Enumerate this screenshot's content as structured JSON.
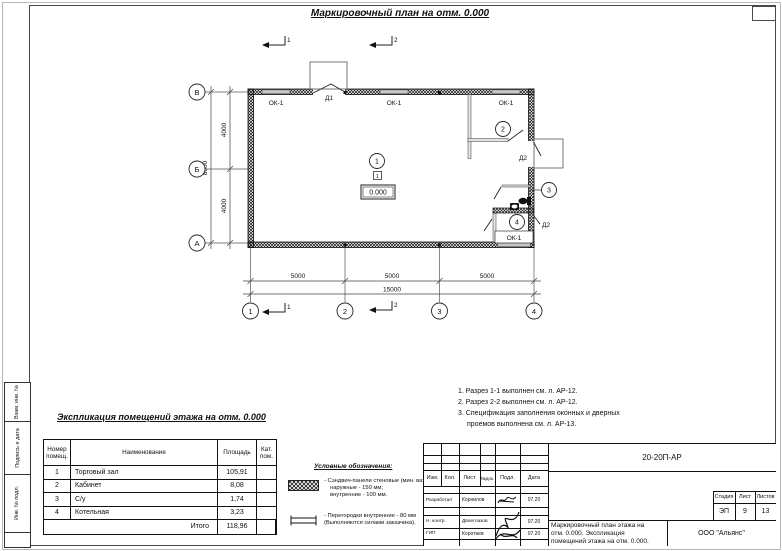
{
  "title": "Маркировочный план на отм. 0.000",
  "plan": {
    "window_label": "ОК-1",
    "door1": "Д1",
    "door2": "Д2",
    "room1": "1",
    "room2": "2",
    "room3": "3",
    "room4": "4",
    "floor_type": "1",
    "elevation": "0.000",
    "section1": "1",
    "section2": "2",
    "axis_rows": {
      "top": "В",
      "mid": "Б",
      "bottom": "А"
    },
    "axis_cols": {
      "c1": "1",
      "c2": "2",
      "c3": "3",
      "c4": "4"
    },
    "dims": {
      "v1": "4000",
      "v2": "4000",
      "v_total": "8000",
      "h1": "5000",
      "h2": "5000",
      "h3": "5000",
      "h_total": "15000"
    }
  },
  "notes": {
    "line1": "1. Разрез 1-1 выполнен см. л. АР-12.",
    "line2": "2. Разрез 2-2 выполнен см. л. АР-12.",
    "line3": "3. Спецификация заполнения оконных и дверных",
    "line4": "проемов выполнена см. л. АР-13."
  },
  "explication": {
    "title": "Экспликация помещений этажа на отм. 0.000",
    "col_number": "Номер помещ.",
    "col_name": "Наименование",
    "col_area": "Площадь",
    "col_cat": "Кат. пом.",
    "rows": [
      {
        "num": "1",
        "name": "Торговый зал",
        "area": "105,91"
      },
      {
        "num": "2",
        "name": "Кабинет",
        "area": "8,08"
      },
      {
        "num": "3",
        "name": "С/у",
        "area": "1,74"
      },
      {
        "num": "4",
        "name": "Котельная",
        "area": "3,23"
      }
    ],
    "total_label": "Итого",
    "total": "118,96"
  },
  "legend": {
    "title": "Условные обозначения:",
    "item1_line1": "- Сэндвич-панели стеновые (мин. вата):",
    "item1_line2": "наружные - 150 мм;",
    "item1_line3": "внутренние - 100 мм.",
    "item2_line1": "- Перегородки внутренние - 80 мм",
    "item2_line2": "(Выполняются силами заказчика)."
  },
  "stamp": {
    "doc_number": "20-20П-АР",
    "cols": {
      "izm": "Изм.",
      "kol": "Кол.",
      "list": "Лист",
      "ndoc": "№док.",
      "podp": "Подл.",
      "data": "Дата"
    },
    "row1_role": "Разработал",
    "row1_name": "Корнилов",
    "row1_date": "07.20",
    "row2_role": "Н. контр.",
    "row2_name": "Двоеглазов",
    "row2_date": "07.20",
    "row3_role": "ГИП",
    "row3_name": "Коротаев",
    "row3_date": "07.20",
    "title_line1": "Маркировочный план этажа на",
    "title_line2": "отм. 0.000. Экспликация",
    "title_line3": "помещений этажа на отм. 0.000.",
    "stage_label": "Стадия",
    "stage": "ЭП",
    "sheet_label": "Лист",
    "sheet": "9",
    "sheets_label": "Листов",
    "sheets": "13",
    "company": "ООО \"Альянс\""
  },
  "margin": {
    "v1": "Взам. инв. №",
    "v2": "Подпись и дата",
    "v3": "Инв. № подл."
  }
}
